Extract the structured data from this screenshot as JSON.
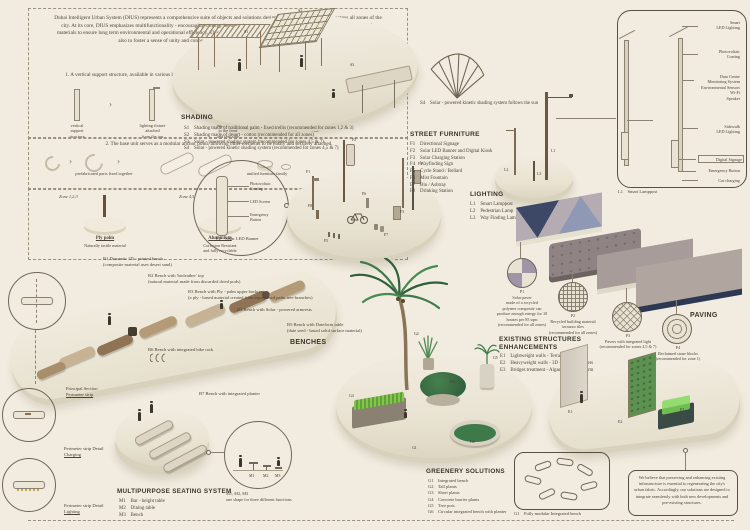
{
  "page": {
    "bg": "#f1ecdf",
    "ink": "#4c4337",
    "navy": "#2d3852",
    "green": "#4e8a55",
    "wood": "#6d573e"
  },
  "intro": {
    "paragraph": "Dubai Intelligent Urban System (DIUS) represents a comprehensive suite of objects and solutions designed for seamless integration across all zones of the city. At its core, DIUS emphasizes multifunctionality - encouraging synergy between individual components - and the use of innovative, sustainable materials to ensure long term environmental and operational efficiency. This forward-thinking approach aims not only to strengthen the urban fabric but also to foster a sense of unity and connectivity among diverse communities throughout Dubai.",
    "logic_title": "Structural logic follows two scenarios:",
    "scenario1": "1. A vertical support structure, available in various lengths but maintaining a consistent profile, functions as a central totem to which other modular elements can be seamlessly connected",
    "arrow": "›",
    "s1_labels": [
      "vertical\nsupport\nstructure",
      "lighting fixture\nattached\nfrom the top",
      "banner fixed\nto the front\nand rear side",
      "versatile\nurban furniture"
    ],
    "scenario2": "2. The base unit serves as a modular anchor point, allowing other elements to be easily and securely attached.",
    "s2_labels": [
      "prefabricated parts fixed together",
      "unified furniture family"
    ]
  },
  "materials": {
    "zones": [
      "Zone 1,2,3",
      "Zone 4,5",
      "Zone 6,7"
    ],
    "names": [
      "Ply palm",
      "Aluminium",
      "Metal"
    ],
    "descs": [
      "Naturally tactile material",
      "Corrosion Resistant\nand fully recyclable",
      "Discreet and Minimal\nAppearance"
    ]
  },
  "shading": {
    "title": "SHADING",
    "items": [
      "S1    Shading made of traditional palm - fixed trellis (recommended for zones 1,2 & 3)",
      "S2    Shading made of desert - cotton (recommended for all zones)",
      "S3    Solar - powered shading system (recommended for zones 4,5 & 7)",
      "S4    Solar - powered kinetic shading system (recommended for zones 4,5 & 7)"
    ],
    "s4_caption": "S4    Solar - powered kinetic shading system follows the sun",
    "tags": [
      "S1",
      "S2",
      "S3"
    ]
  },
  "banner_detail": {
    "labels": [
      "Photovoltaic\nCoating",
      "LED Screen",
      "Emergency\nButton"
    ],
    "caption": "F2    Solar LED Banner"
  },
  "street_furniture": {
    "title": "STREET FURNITURE",
    "items": [
      "F1    Directional Signage",
      "F2    Solar LED Banner and Digital Kiosk",
      "F3    Solar Charging Station",
      "F4    Wayfinding Sign",
      "F5    Cycle Stand / Bollard",
      "F6    Mist Fountain",
      "F7    Bin / Ashtray",
      "F8    Drinking Station"
    ],
    "tags": [
      "F1",
      "F2",
      "F3",
      "F4",
      "F5",
      "F6",
      "F7",
      "F8"
    ]
  },
  "lighting": {
    "title": "LIGHTING",
    "items": [
      "L1    Smart Lamppost",
      "L2    Pedestrian Lamp",
      "L3    Way Finding Lamp"
    ],
    "tags": [
      "L1",
      "L2",
      "L3"
    ]
  },
  "lamppost": {
    "label_top": "Smart\nLED Lighting",
    "label_pv": "Photovoltaic\nCoating",
    "label_data": "Data Centre\nMonitoring System\nEnvironmental Sensors\nWi-Fi\nSpeaker",
    "label_sidewalk": "Sidewalk\nLED Lighting",
    "label_signage": "Digital Signage",
    "label_emergency": "Emergency Button",
    "label_charging": "Car charging",
    "caption": "L1    Smart Lamppost"
  },
  "paving": {
    "title": "PAVING",
    "p1": "P1\nSolar paver\nmade of a recycled\npolymer composite can\nproduce enough energy for 10\nhouses per 85 sqm\n(recommended for all zones)",
    "p2": "P2\nRecycled building material\nterrazzo tiles\n(recommended for all zones)",
    "p3": "P3\nPavers with integrated light\n(recommended for zones 4,5 & 7)",
    "p4": "P4\nReclaimed stone blocks\n(recommended for zone 1)"
  },
  "benches": {
    "title": "BENCHES",
    "b1": "B1    Domestic 3D - printed bench\n(composite material uses desert sand)",
    "b2": "B2    Bench with 'bioleather' top\n(natural material made from discarded dried pods)",
    "b3": "B3    Bench with Ply - palm upper backrest\n(a ply - based material created from repurposed palm tree branches)",
    "b4": "B4    Bench with Solar - powered armrests",
    "b5": "B5    Bench with Dateform table\n(date seed - based solid surface material)",
    "b6": "B6    Bench with integrated bike rack",
    "b7": "B7    Bench with integrated planter"
  },
  "section_details": {
    "principal1": "Principal Section",
    "principal2": "Perimeter strip",
    "charging1": "Perimeter strip Detail",
    "charging2": "Charging",
    "lighting1": "Perimeter strip Detail",
    "lighting2": "Lighting"
  },
  "multipurpose": {
    "title": "MULTIPURPOSE SEATING SYSTEM",
    "items": [
      "M1    Bar - height table",
      "M2    Dining table",
      "M3    Bench"
    ],
    "tags": [
      "M1",
      "M2",
      "M3"
    ],
    "note": "M1, M2, M3\none shape for three different functions"
  },
  "greenery": {
    "title": "GREENERY SOLUTIONS",
    "items": [
      "G1    Integrated bench",
      "G2    Tall plants",
      "G3    Short plants",
      "G4    Concrete barrier plants",
      "G5    Tree pots",
      "G6    Circular integrated bench with planter"
    ],
    "tags": [
      "G1",
      "G2",
      "G3",
      "G4",
      "G5",
      "G6"
    ],
    "g1_caption": "G1    Fully modular Integrated bench"
  },
  "existing": {
    "title1": "EXISTING STRUCTURES",
    "title2": "ENHANCEMENTS",
    "items": [
      "E1    Lightweight walls - Terracotta Tiles",
      "E2    Heavyweight walls - 3D - Printed Planters",
      "E3    Bridges treatment - Algae cultivation farm"
    ],
    "tags": [
      "E1",
      "E2",
      "E3"
    ]
  },
  "belief": {
    "text": "We believe that preserving and enhancing existing infrastructure is essential to regenerating the city's urban fabric. Accordingly, our solutions are designed to integrate seamlessly with both new developments and pre-existing structures."
  }
}
